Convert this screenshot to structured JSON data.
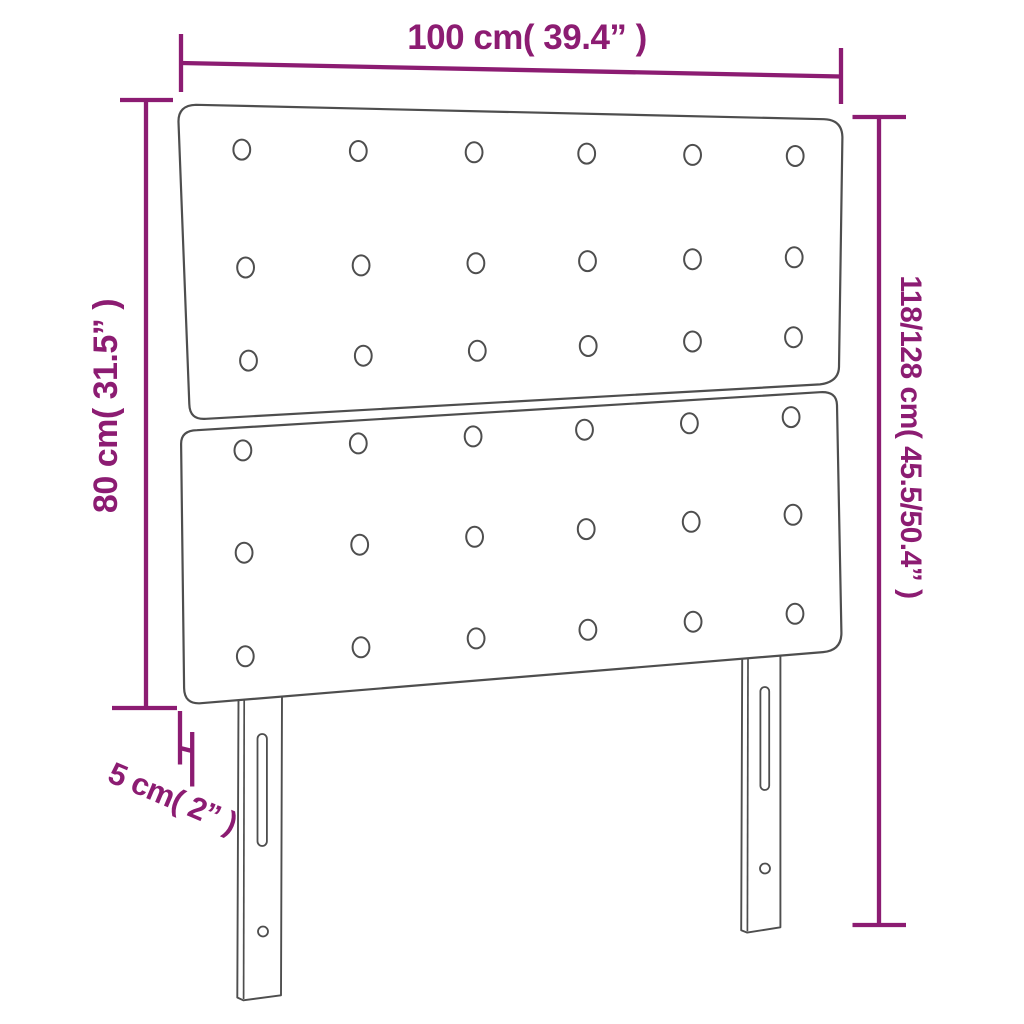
{
  "diagram": {
    "kind": "furniture-dimension-drawing",
    "subject": "tufted-headboard-with-two-legs"
  },
  "colors": {
    "dimension": "#8C1C72",
    "outline": "#4E4E4E",
    "background": "#FFFFFF"
  },
  "dimensions": {
    "width": {
      "label": "100 cm( 39.4” )",
      "orientation": "horizontal-top"
    },
    "panel_height": {
      "label": "80 cm( 31.5” )",
      "orientation": "vertical-left"
    },
    "total_height": {
      "label": "118/128 cm( 45.5/50.4” )",
      "orientation": "vertical-right"
    },
    "depth": {
      "label": "5 cm( 2” )",
      "orientation": "diagonal-bottom-left"
    }
  },
  "figure": {
    "panels": [
      {
        "name": "upper-panel",
        "path": "M 196 104.8 L 824 119.2 Q 842 119.8 842.4 137 L 839 367 Q 838.6 382 820 384.4 L 206 418.8 Q 189.6 420.2 189.3 404 L 178.5 122 Q 178.1 105.2 196 104.8 Z",
        "buttons": {
          "corners": {
            "tl": [
              178,
              104.8
            ],
            "tr": [
              842,
              119.8
            ],
            "bl": [
              189.3,
              420
            ],
            "br": [
              838.5,
              382.5
            ]
          },
          "cols": [
            0.094,
            0.27,
            0.445,
            0.615,
            0.775,
            0.93
          ],
          "rows": [
            0.14,
            0.52,
            0.82
          ],
          "rx": 8.4,
          "ry": 10
        }
      },
      {
        "name": "lower-panel",
        "path": "M 197 430.2 L 820 392.2 Q 836.5 391 837 405 L 841.4 632 Q 841.9 650.5 823 652.1 L 201 703.2 Q 184.3 704.6 184.1 688 L 181.1 444 Q 181 430.5 197 430.2 Z",
        "buttons": {
          "corners": {
            "tl": [
              181,
              429.5
            ],
            "tr": [
              836.5,
              391
            ],
            "bl": [
              184,
              703.5
            ],
            "br": [
              841.8,
              650.5
            ]
          },
          "cols": [
            0.094,
            0.27,
            0.445,
            0.615,
            0.775,
            0.93
          ],
          "rows": [
            0.09,
            0.465,
            0.845
          ],
          "rx": 8.4,
          "ry": 10
        }
      }
    ],
    "legs": [
      {
        "name": "left-leg",
        "outline": "M 238.5 698 L 237.3 997.5 L 243.3 1000.3 L 281 995.3 L 282 696",
        "inner": "M 244.2 699 L 243.6 999",
        "slot": {
          "x": 257.5,
          "y": 734,
          "w": 9.4,
          "h": 112,
          "r": 4.7
        },
        "hole": {
          "cx": 263,
          "cy": 931.5,
          "r": 5
        }
      },
      {
        "name": "right-leg",
        "outline": "M 742.2 658 L 741.2 930.3 L 747.2 932.6 L 780.4 927.3 L 780.4 655",
        "inner": "M 748 659 L 747.4 931.3",
        "slot": {
          "x": 760.4,
          "y": 687,
          "w": 8.8,
          "h": 103,
          "r": 4.4
        },
        "hole": {
          "cx": 765,
          "cy": 868.5,
          "r": 5
        }
      }
    ]
  }
}
